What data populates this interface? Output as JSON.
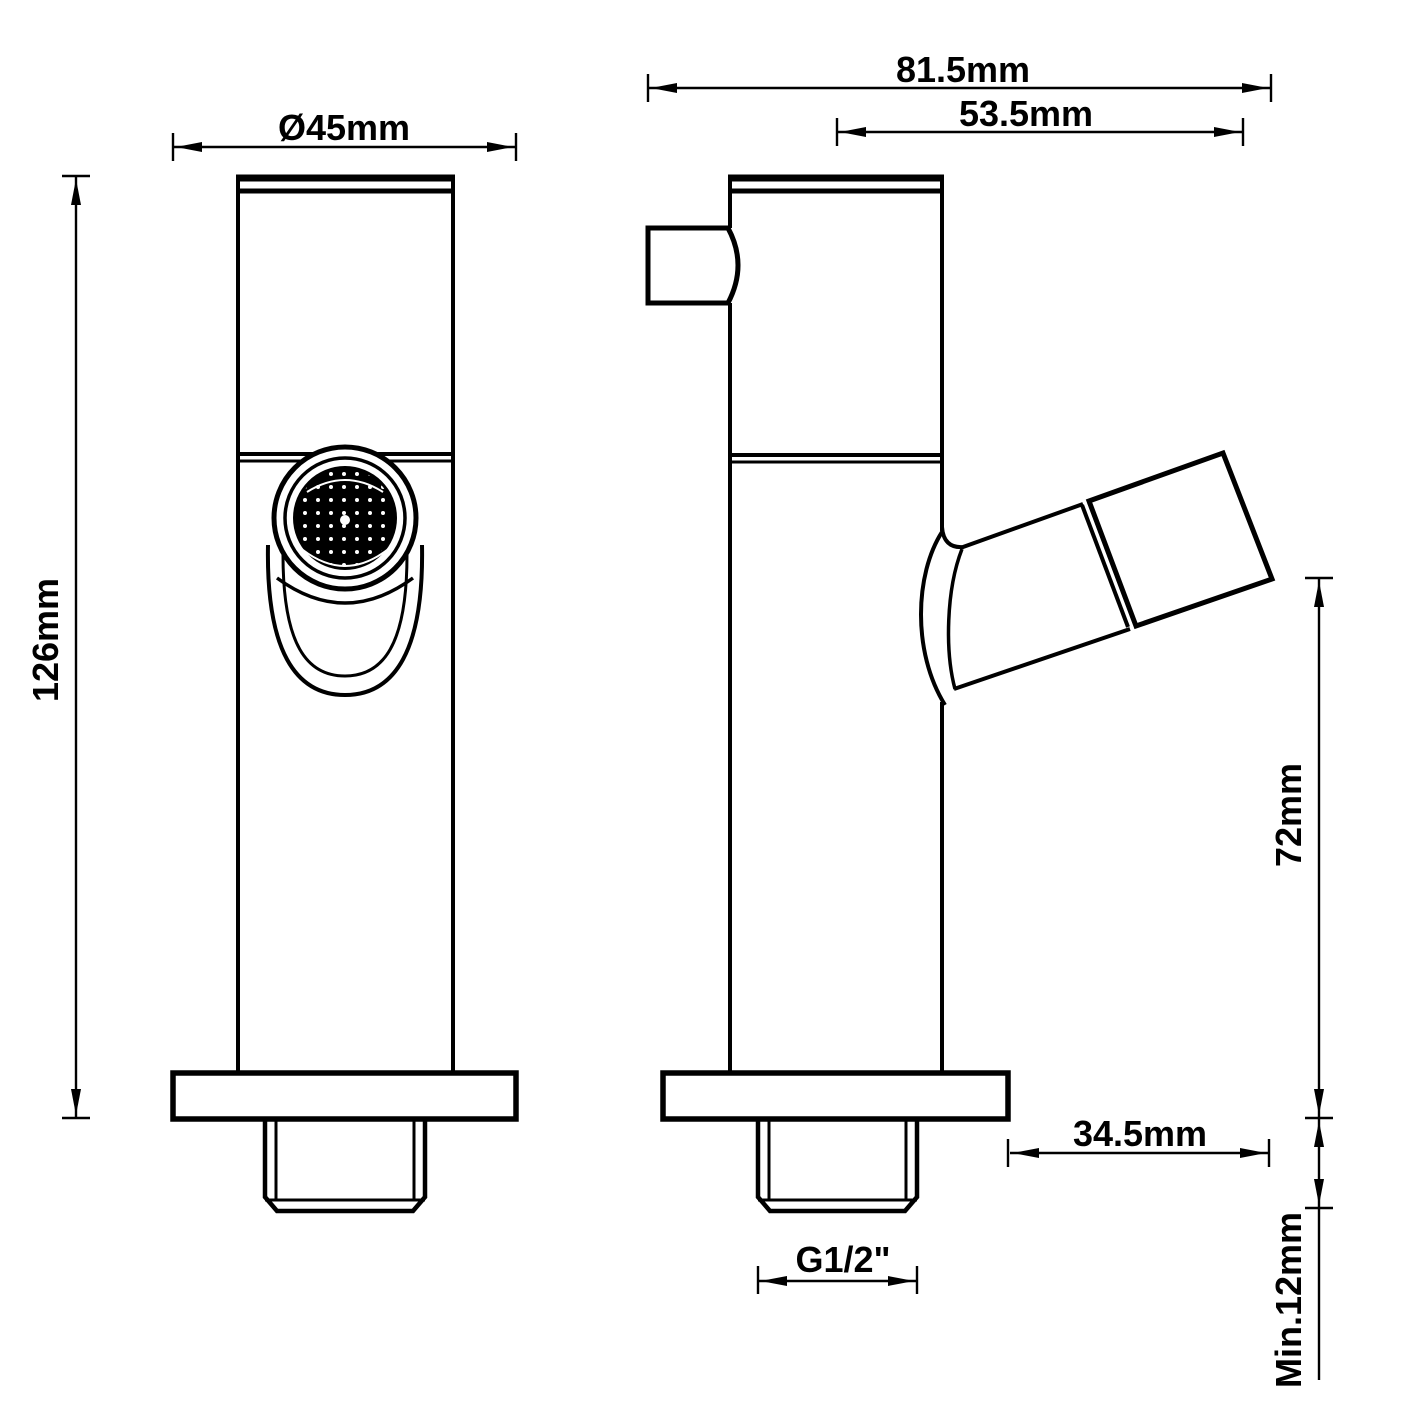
{
  "drawing": {
    "background": "#ffffff",
    "line_color": "#000000",
    "labels": {
      "flange_diameter": "Ø45mm",
      "overall_depth": "81.5mm",
      "spout_reach": "53.5mm",
      "body_height": "126mm",
      "spout_clearance": "72mm",
      "spout_overhang": "34.5mm",
      "thread_length": "Min.12mm",
      "thread_size": "G1/2\""
    }
  }
}
